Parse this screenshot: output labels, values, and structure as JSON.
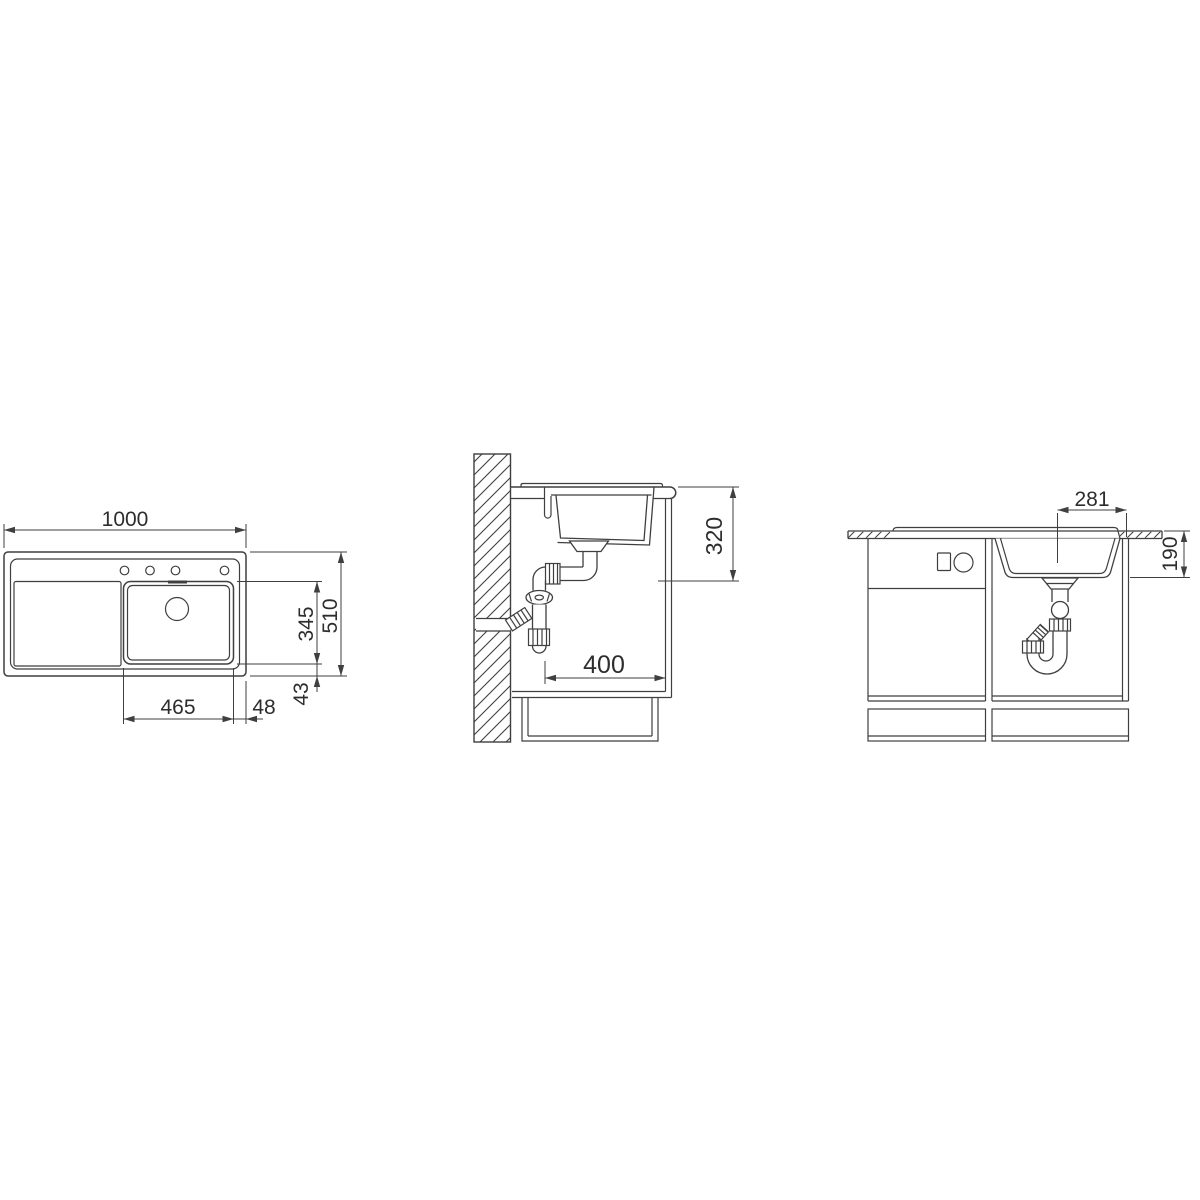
{
  "colors": {
    "background": "#ffffff",
    "line": "#3f3f3f",
    "dimension_text": "#2d2d2d"
  },
  "top_view": {
    "dim_overall_length": "1000",
    "dim_overall_width": "510",
    "dim_bowl_width": "345",
    "dim_bowl_length": "465",
    "dim_edge_right": "48",
    "dim_edge_bottom": "43"
  },
  "side_view": {
    "dim_drain_height": "320",
    "dim_drain_depth": "400"
  },
  "front_view": {
    "dim_drain_offset": "281",
    "dim_bowl_depth": "190"
  }
}
